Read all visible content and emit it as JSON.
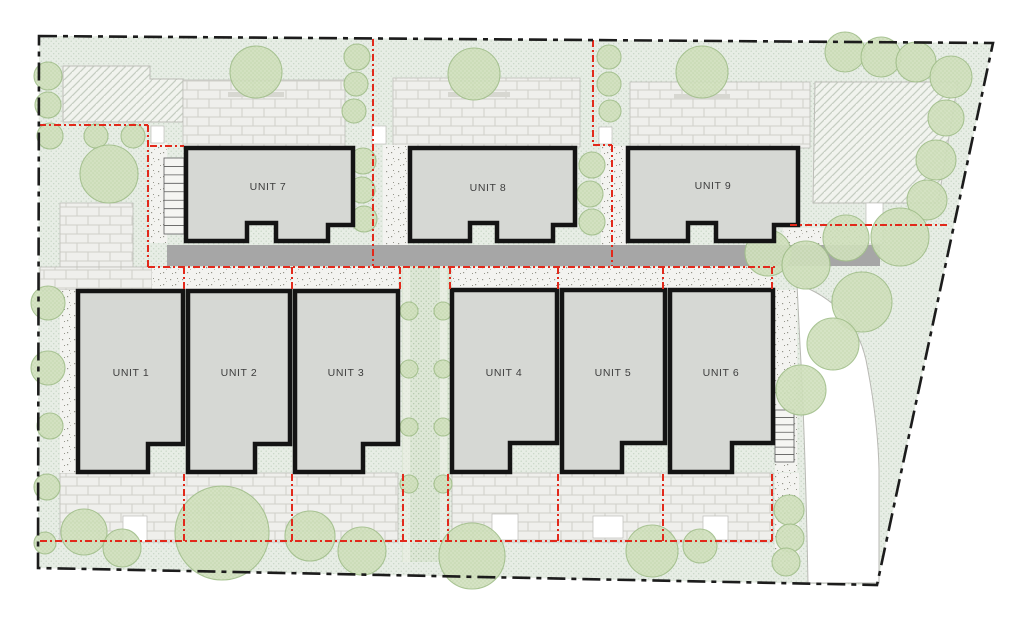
{
  "plan_title": "Residential site plan - 9 units",
  "colors": {
    "page_bg": "#ffffff",
    "lawn": "#e7ede5",
    "lawn_dot": "#c6d6c5",
    "path": "#dde7d6",
    "path_dot": "#b3c9ab",
    "path_edge": "#f2f4ee",
    "brick": "#efefec",
    "brick_line": "#cfcfc9",
    "speckle_bg": "#f3f3f0",
    "speckle_dot": "#96968c",
    "hatch_bg": "#f1f3ee",
    "hatch_line": "#c6cec2",
    "road": "#a6a6a6",
    "building_fill": "#d6d8d4",
    "building_stroke": "#141414",
    "tree_fill": "#d2e1bf",
    "tree_stroke": "#a2bf8b",
    "red": "#e2291b",
    "boundary": "#1c1c1c",
    "label": "#3d3d3d",
    "white": "#ffffff",
    "ledge": "#d7d7d1",
    "stair_line": "#5a5a5a",
    "outline": "#bdbdb8"
  },
  "site": {
    "boundary_points": "39,36 993,43 877,585 38,568"
  },
  "buildings": [
    {
      "label": "UNIT 1",
      "points": "78,291 183,291 183,444 148,444 148,472 78,472",
      "lx": 131,
      "ly": 376
    },
    {
      "label": "UNIT 2",
      "points": "188,291 290,291 290,444 255,444 255,472 188,472",
      "lx": 239,
      "ly": 376
    },
    {
      "label": "UNIT 3",
      "points": "295,291 398,291 398,444 363,444 363,472 295,472",
      "lx": 346,
      "ly": 376
    },
    {
      "label": "UNIT 4",
      "points": "452,290 557,290 557,443 510,443 510,472 452,472",
      "lx": 504,
      "ly": 376
    },
    {
      "label": "UNIT 5",
      "points": "562,290 665,290 665,443 622,443 622,472 562,472",
      "lx": 613,
      "ly": 376
    },
    {
      "label": "UNIT 6",
      "points": "670,290 773,290 773,443 732,443 732,472 670,472",
      "lx": 721,
      "ly": 376
    },
    {
      "label": "UNIT 7",
      "points": "186,148 353,148 353,225 328,225 328,241 276,241 276,223 247,223 247,241 186,241",
      "lx": 268,
      "ly": 190
    },
    {
      "label": "UNIT 8",
      "points": "410,148 575,148 575,225 553,225 553,241 497,241 497,223 470,223 470,241 410,241",
      "lx": 488,
      "ly": 191
    },
    {
      "label": "UNIT 9",
      "points": "628,148 798,148 798,225 774,225 774,241 716,241 716,223 688,223 688,241 628,241",
      "lx": 713,
      "ly": 189
    }
  ],
  "ground": {
    "hatches": [
      "63,66 150,66 150,79 183,79 183,122 63,122",
      "815,82 958,82 938,203 813,203"
    ],
    "bricks": [
      [
        183,
        80,
        162,
        67
      ],
      [
        393,
        78,
        187,
        69
      ],
      [
        630,
        82,
        180,
        66
      ],
      [
        60,
        203,
        73,
        64
      ],
      [
        40,
        267,
        112,
        23
      ],
      [
        60,
        473,
        338,
        69
      ],
      [
        452,
        473,
        321,
        69
      ]
    ],
    "white_rects": [
      [
        151,
        126,
        13,
        17
      ],
      [
        372,
        126,
        14,
        18
      ],
      [
        599,
        127,
        13,
        17
      ],
      [
        123,
        516,
        24,
        26
      ],
      [
        492,
        514,
        26,
        26
      ],
      [
        593,
        516,
        30,
        22
      ],
      [
        703,
        516,
        25,
        24
      ],
      [
        866,
        203,
        17,
        41
      ]
    ],
    "speckles": [
      [
        150,
        143,
        17,
        100
      ],
      [
        383,
        145,
        25,
        121
      ],
      [
        601,
        146,
        27,
        120
      ],
      [
        152,
        267,
        246,
        23
      ],
      [
        452,
        267,
        320,
        23
      ],
      [
        60,
        290,
        18,
        183
      ],
      [
        775,
        290,
        22,
        182
      ],
      [
        775,
        473,
        24,
        95
      ],
      [
        783,
        228,
        107,
        17
      ]
    ],
    "road": [
      167,
      245,
      713,
      21
    ],
    "path": [
      402,
      266,
      48,
      296
    ],
    "path_edges": [
      [
        403,
        266,
        7,
        296
      ],
      [
        440,
        266,
        7,
        296
      ]
    ],
    "ledges": [
      [
        228,
        92,
        56,
        5
      ],
      [
        448,
        92,
        62,
        5
      ],
      [
        674,
        94,
        56,
        5
      ]
    ],
    "stairs": [
      [
        164,
        158,
        20,
        76,
        9
      ],
      [
        775,
        410,
        19,
        52,
        7
      ]
    ],
    "white_area": "M 797 284 Q 853 304 866 360 Q 878 420 879 470 L 879 583 L 808 583 Q 805 430 800 345 Q 798 305 797 284 Z"
  },
  "trees": [
    [
      48,
      76,
      14
    ],
    [
      48,
      105,
      13
    ],
    [
      50,
      136,
      13
    ],
    [
      96,
      136,
      12
    ],
    [
      133,
      136,
      12
    ],
    [
      109,
      174,
      29
    ],
    [
      256,
      72,
      26
    ],
    [
      357,
      57,
      13
    ],
    [
      356,
      84,
      12
    ],
    [
      354,
      111,
      12
    ],
    [
      474,
      74,
      26
    ],
    [
      609,
      57,
      12
    ],
    [
      609,
      84,
      12
    ],
    [
      610,
      111,
      11
    ],
    [
      702,
      72,
      26
    ],
    [
      845,
      52,
      20
    ],
    [
      881,
      57,
      20
    ],
    [
      916,
      62,
      20
    ],
    [
      951,
      77,
      21
    ],
    [
      946,
      118,
      18
    ],
    [
      936,
      160,
      20
    ],
    [
      927,
      200,
      20
    ],
    [
      363,
      161,
      13
    ],
    [
      362,
      190,
      13
    ],
    [
      364,
      219,
      13
    ],
    [
      592,
      165,
      13
    ],
    [
      590,
      194,
      13
    ],
    [
      592,
      222,
      13
    ],
    [
      48,
      303,
      17
    ],
    [
      48,
      368,
      17
    ],
    [
      50,
      426,
      13
    ],
    [
      47,
      487,
      13
    ],
    [
      45,
      543,
      11
    ],
    [
      768,
      253,
      23
    ],
    [
      806,
      265,
      24
    ],
    [
      846,
      238,
      23
    ],
    [
      900,
      237,
      29
    ],
    [
      862,
      302,
      30
    ],
    [
      833,
      344,
      26
    ],
    [
      801,
      390,
      25
    ],
    [
      409,
      311,
      9
    ],
    [
      443,
      311,
      9
    ],
    [
      409,
      369,
      9
    ],
    [
      443,
      369,
      9
    ],
    [
      409,
      427,
      9
    ],
    [
      443,
      427,
      9
    ],
    [
      409,
      484,
      9
    ],
    [
      443,
      484,
      9
    ],
    [
      789,
      510,
      15
    ],
    [
      790,
      538,
      14
    ],
    [
      786,
      562,
      14
    ],
    [
      84,
      532,
      23
    ],
    [
      122,
      548,
      19
    ],
    [
      222,
      533,
      47
    ],
    [
      310,
      536,
      25
    ],
    [
      362,
      551,
      24
    ],
    [
      472,
      556,
      33
    ],
    [
      652,
      551,
      26
    ],
    [
      700,
      546,
      17
    ]
  ],
  "red_lines": [
    "M39,125 H148",
    "M148,125 V267",
    "M150,146 H184",
    "M373,39 V266",
    "M593,40 V145",
    "M593,145 H612",
    "M612,145 V266",
    "M148,267 H775",
    "M790,225 H950",
    "M40,541 H772",
    "M772,541 V474",
    "M184,267 V291",
    "M292,267 V291",
    "M400,267 V291",
    "M450,267 V291",
    "M558,267 V291",
    "M663,267 V291",
    "M772,267 V291",
    "M184,474 V541",
    "M292,474 V541",
    "M403,474 V541",
    "M448,474 V541",
    "M558,474 V541",
    "M663,474 V541"
  ]
}
